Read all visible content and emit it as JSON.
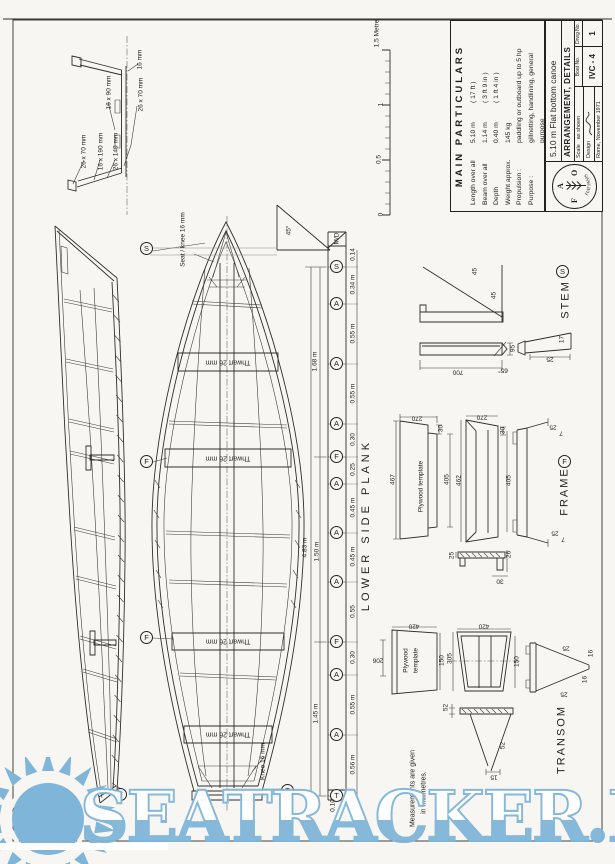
{
  "title_block": {
    "mp_title": "MAIN  PARTICULARS",
    "rows": [
      {
        "l": "Length over all",
        "v": "5.10 m",
        "a": "( 17 ft )"
      },
      {
        "l": "Beam over all",
        "v": "1.14 m",
        "a": "( 3 ft 9 in )"
      },
      {
        "l": "Depth",
        "v": "0.40 m",
        "a": "( 1 ft 4 in )"
      },
      {
        "l": "Weight approx.",
        "v": "145 kg",
        "a": ""
      },
      {
        "l": "Propulsion :",
        "v": "paddling or outboard  up to 5 hp",
        "a": ""
      },
      {
        "l": "Purpose :",
        "v": "gillnetting, handlining, general purpose",
        "a": ""
      }
    ],
    "fao": [
      "F",
      "A",
      "O"
    ],
    "motto": "FIAT PANIS",
    "boat_title": "5.10 m Flat bottom canoe",
    "sheet_title": "ARRANGEMENT, DETAILS",
    "scale_label": "Scale",
    "scale_value": "as shown",
    "design_label": "Design",
    "place_date": "Rome, November 1971",
    "boat_no_label": "Boat No.",
    "boat_no": "IVC - 4",
    "drwg_no_label": "Drwg No.",
    "drwg_no": "1"
  },
  "scale_bar": {
    "ticks": [
      "0",
      "0.5",
      "1",
      "1.5 Metre"
    ]
  },
  "section": {
    "labels": [
      "16 mm",
      "26 x 70 mm",
      "16 x 90 mm",
      "26 x 70 mm",
      "16 x 190 mm",
      "26 x 140 mm"
    ]
  },
  "marks": {
    "s": "S",
    "f": "F",
    "t": "T"
  },
  "plan": {
    "thwart": "Thwart 26 mm",
    "seat_knee": "Seat / knee  16 mm",
    "knee": "Knee  16 mm"
  },
  "strip": {
    "plank_label": "LOWER  SIDE  PLANK",
    "md": "M/D",
    "angle": "45°",
    "stations": [
      "S",
      "A",
      "A",
      "A",
      "F",
      "A",
      "A",
      "A",
      "F",
      "A",
      "A",
      "T"
    ],
    "dims": [
      "0.14",
      "0.34 m",
      "0.55 m",
      "0.55 m",
      "0.30",
      "0.25",
      "0.45 m",
      "0.45 m",
      "0.55",
      "0.30",
      "0.55 m",
      "0.56 m",
      "0.04",
      "0.10"
    ],
    "overall": [
      "1.68 m",
      "4.83 m",
      "1.50 m",
      "1.45 m"
    ]
  },
  "stem": {
    "title": "STEM",
    "mark": "S",
    "d45a": "45",
    "d45b": "45",
    "d700": "700",
    "d95": "95",
    "a65": "65°",
    "d25": "25",
    "d17": "17"
  },
  "frame": {
    "title": "FRAME",
    "mark": "F",
    "tpl": "Plywood template",
    "d270a": "270",
    "d30a": "30",
    "d467": "467",
    "d405a": "405",
    "d270b": "270",
    "d30b": "30",
    "d462": "462",
    "d405b": "405",
    "s25a": "25",
    "s7a": "7",
    "s25b": "25",
    "s7b": "7",
    "b25": "25",
    "b26": "26",
    "b30": "30"
  },
  "transom": {
    "title": "TRANSOM",
    "tpl1": "Plywood",
    "tpl2": "template",
    "d420a": "420",
    "d150a": "150",
    "d206": "206",
    "d420b": "420",
    "d305": "305",
    "d150b": "150",
    "e25a": "25",
    "e16a": "16",
    "e16b": "16",
    "e25b": "25",
    "v52a": "52",
    "v52b": "52",
    "v15": "15"
  },
  "note": {
    "line1": "Measurements  are  given",
    "line2": "in  millimetres."
  },
  "watermark": {
    "text": "SEATRACKER.RU"
  }
}
